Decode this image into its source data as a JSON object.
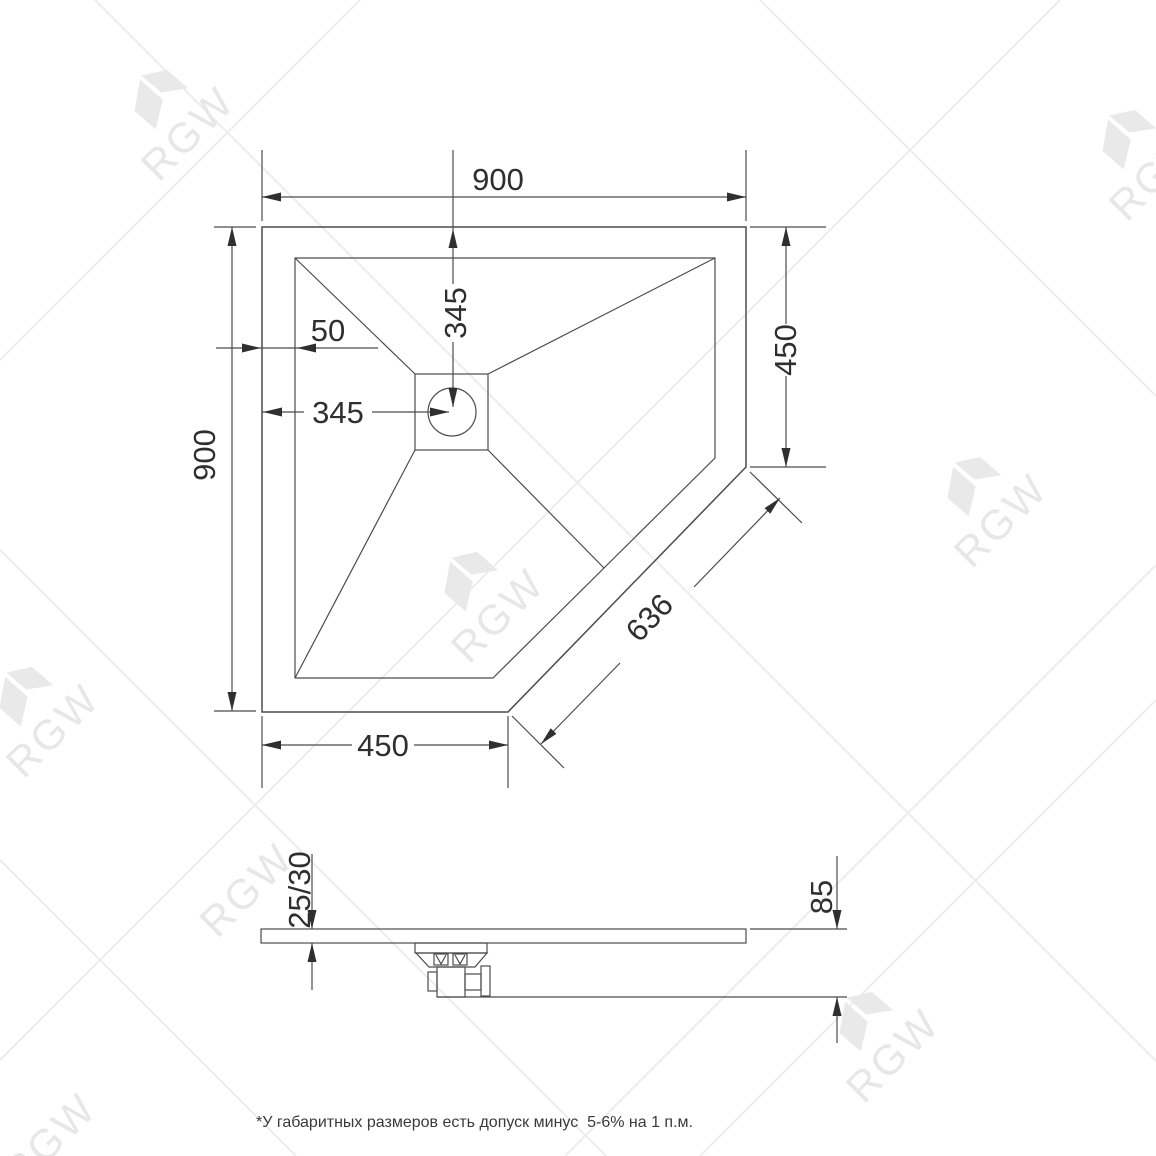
{
  "watermark": {
    "text": "RGW"
  },
  "dims": {
    "top_width": "900",
    "left_height": "900",
    "drain_from_top": "345",
    "drain_from_left": "345",
    "rim": "50",
    "right_side": "450",
    "bottom_side": "450",
    "chamfer": "636",
    "thickness": "25/30",
    "height": "85"
  },
  "footnote": "*У габаритных размеров есть допуск минус  5-6% на 1 п.м.",
  "colors": {
    "line": "#4c4c4c",
    "text": "#2f2f2f",
    "watermark": "#e9e9e9",
    "background": "#ffffff"
  }
}
